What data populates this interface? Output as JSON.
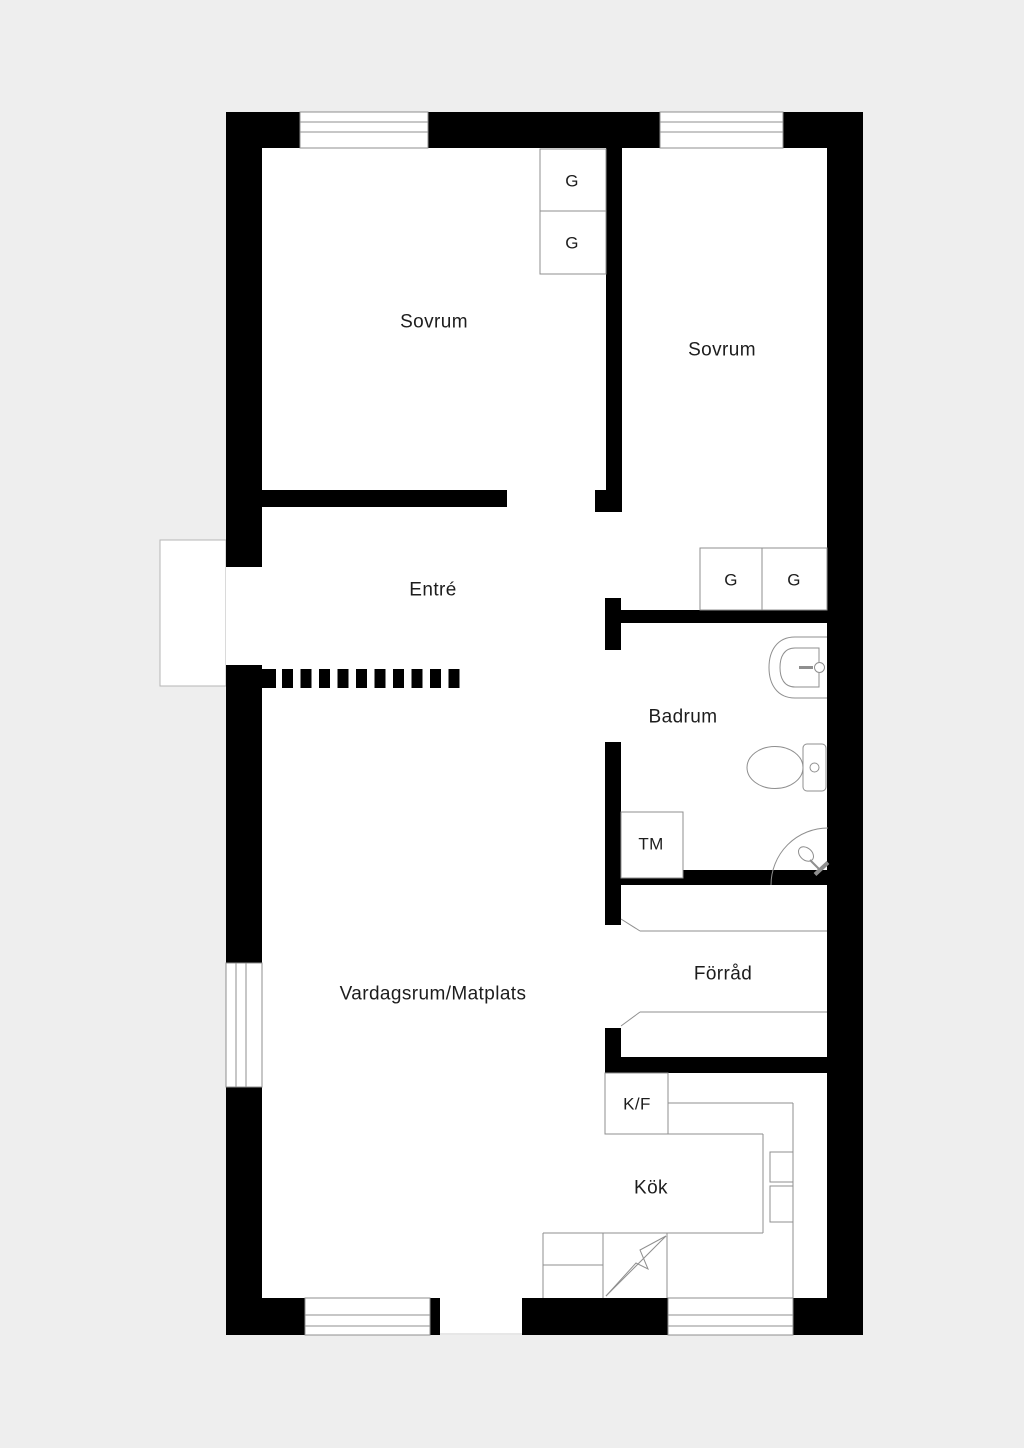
{
  "colors": {
    "background": "#eeeeee",
    "floor": "#ffffff",
    "wall": "#000000",
    "line": "#8f8f8f",
    "line_light": "#b5b5b5",
    "threshold": "#cfcfcf",
    "text": "#1d1d1d"
  },
  "labels": [
    {
      "name": "room-label-sovrum-1",
      "text": "Sovrum",
      "x": 434,
      "y": 322,
      "size": 19
    },
    {
      "name": "room-label-sovrum-2",
      "text": "Sovrum",
      "x": 722,
      "y": 350,
      "size": 19
    },
    {
      "name": "room-label-entre",
      "text": "Entré",
      "x": 433,
      "y": 590,
      "size": 19
    },
    {
      "name": "room-label-badrum",
      "text": "Badrum",
      "x": 683,
      "y": 717,
      "size": 19
    },
    {
      "name": "room-label-forrad",
      "text": "Förråd",
      "x": 723,
      "y": 974,
      "size": 19
    },
    {
      "name": "room-label-kok",
      "text": "Kök",
      "x": 651,
      "y": 1188,
      "size": 19
    },
    {
      "name": "room-label-vardagsrum",
      "text": "Vardagsrum/Matplats",
      "x": 433,
      "y": 994,
      "size": 19
    },
    {
      "name": "appliance-label-tm",
      "text": "TM",
      "x": 651,
      "y": 844,
      "size": 17
    },
    {
      "name": "appliance-label-kf",
      "text": "K/F",
      "x": 637,
      "y": 1104,
      "size": 17
    },
    {
      "name": "closet-label-g-1",
      "text": "G",
      "x": 572,
      "y": 181,
      "size": 17
    },
    {
      "name": "closet-label-g-2",
      "text": "G",
      "x": 572,
      "y": 243,
      "size": 17
    },
    {
      "name": "closet-label-g-3",
      "text": "G",
      "x": 731,
      "y": 580,
      "size": 17
    },
    {
      "name": "closet-label-g-4",
      "text": "G",
      "x": 794,
      "y": 580,
      "size": 17
    }
  ],
  "plan": {
    "porch": {
      "name": "entrance-porch",
      "x": 160,
      "y": 540,
      "w": 66,
      "h": 146
    },
    "floor": {
      "name": "interior-floor",
      "x": 262,
      "y": 148,
      "w": 565,
      "h": 1150
    },
    "walls": [
      {
        "name": "wall-top",
        "x": 226,
        "y": 112,
        "w": 637,
        "h": 36
      },
      {
        "name": "wall-bottom",
        "x": 226,
        "y": 1298,
        "w": 637,
        "h": 37
      },
      {
        "name": "wall-left",
        "x": 226,
        "y": 112,
        "w": 36,
        "h": 1223
      },
      {
        "name": "wall-right",
        "x": 827,
        "y": 112,
        "w": 36,
        "h": 1223
      },
      {
        "name": "wall-sovrum1-south",
        "x": 262,
        "y": 490,
        "w": 245,
        "h": 17
      },
      {
        "name": "wall-bedroom-divider",
        "x": 606,
        "y": 148,
        "w": 16,
        "h": 364
      },
      {
        "name": "wall-door-jamb",
        "x": 595,
        "y": 490,
        "w": 27,
        "h": 22
      },
      {
        "name": "wall-hall-segment",
        "x": 605,
        "y": 598,
        "w": 16,
        "h": 52
      },
      {
        "name": "wall-badrum-north",
        "x": 621,
        "y": 610,
        "w": 206,
        "h": 13
      },
      {
        "name": "wall-badrum-west",
        "x": 605,
        "y": 742,
        "w": 16,
        "h": 183
      },
      {
        "name": "wall-forrad-north",
        "x": 621,
        "y": 870,
        "w": 206,
        "h": 15
      },
      {
        "name": "wall-forrad-west",
        "x": 605,
        "y": 1028,
        "w": 16,
        "h": 29
      },
      {
        "name": "wall-kitchen-north",
        "x": 605,
        "y": 1057,
        "w": 222,
        "h": 16
      },
      {
        "name": "wall-divider-stub",
        "x": 262,
        "y": 669,
        "w": 14,
        "h": 19
      }
    ],
    "openings": [
      {
        "name": "entrance-opening",
        "x": 226,
        "y": 567,
        "w": 36,
        "h": 98
      },
      {
        "name": "patio-opening",
        "x": 440,
        "y": 1298,
        "w": 82,
        "h": 37
      }
    ],
    "windows": [
      {
        "name": "window-top-left",
        "x": 300,
        "y": 112,
        "w": 128,
        "h": 36,
        "dir": "h",
        "lines": [
          122,
          132
        ]
      },
      {
        "name": "window-top-right",
        "x": 660,
        "y": 112,
        "w": 123,
        "h": 36,
        "dir": "h",
        "lines": [
          122,
          132
        ]
      },
      {
        "name": "window-left",
        "x": 226,
        "y": 963,
        "w": 36,
        "h": 124,
        "dir": "v",
        "lines": [
          236,
          246
        ]
      },
      {
        "name": "window-bottom-left",
        "x": 305,
        "y": 1298,
        "w": 125,
        "h": 37,
        "dir": "h",
        "lines": [
          1315,
          1326
        ]
      },
      {
        "name": "window-bottom-right",
        "x": 668,
        "y": 1298,
        "w": 125,
        "h": 37,
        "dir": "h",
        "lines": [
          1315,
          1326
        ]
      }
    ],
    "furniture_boxes": [
      {
        "name": "wardrobe-g1",
        "x": 540,
        "y": 149,
        "w": 66,
        "h": 62
      },
      {
        "name": "wardrobe-g2",
        "x": 540,
        "y": 211,
        "w": 66,
        "h": 63
      },
      {
        "name": "wardrobe-g3",
        "x": 700,
        "y": 548,
        "w": 62,
        "h": 62
      },
      {
        "name": "wardrobe-g4",
        "x": 762,
        "y": 548,
        "w": 65,
        "h": 62
      },
      {
        "name": "washing-machine",
        "x": 621,
        "y": 812,
        "w": 62,
        "h": 66
      },
      {
        "name": "fridge-freezer",
        "x": 605,
        "y": 1073,
        "w": 63,
        "h": 61
      },
      {
        "name": "counter-sink-box-1",
        "x": 770,
        "y": 1152,
        "w": 23,
        "h": 30
      },
      {
        "name": "counter-sink-box-2",
        "x": 770,
        "y": 1186,
        "w": 23,
        "h": 36
      }
    ],
    "lines": [
      {
        "name": "kitchen-counter-edge-top",
        "x1": 668,
        "y1": 1103,
        "x2": 793,
        "y2": 1103
      },
      {
        "name": "kitchen-counter-edge-right",
        "x1": 793,
        "y1": 1103,
        "x2": 793,
        "y2": 1298
      },
      {
        "name": "kitchen-floor-line-top",
        "x1": 605,
        "y1": 1134,
        "x2": 763,
        "y2": 1134
      },
      {
        "name": "kitchen-floor-line-right",
        "x1": 763,
        "y1": 1134,
        "x2": 763,
        "y2": 1233
      },
      {
        "name": "kitchen-floor-line-bottom",
        "x1": 543,
        "y1": 1233,
        "x2": 763,
        "y2": 1233
      },
      {
        "name": "counter-left-edge",
        "x1": 543,
        "y1": 1233,
        "x2": 543,
        "y2": 1298
      },
      {
        "name": "stove-left-edge",
        "x1": 603,
        "y1": 1233,
        "x2": 603,
        "y2": 1298
      },
      {
        "name": "stove-right-edge",
        "x1": 667,
        "y1": 1233,
        "x2": 667,
        "y2": 1298
      },
      {
        "name": "counter-divider",
        "x1": 543,
        "y1": 1265,
        "x2": 603,
        "y2": 1265
      },
      {
        "name": "forrad-door-top",
        "x1": 640,
        "y1": 931,
        "x2": 827,
        "y2": 931
      },
      {
        "name": "forrad-door-top-hinge",
        "x1": 621,
        "y1": 919,
        "x2": 640,
        "y2": 931
      },
      {
        "name": "forrad-door-bottom",
        "x1": 640,
        "y1": 1012,
        "x2": 827,
        "y2": 1012
      },
      {
        "name": "forrad-door-bottom-hinge",
        "x1": 621,
        "y1": 1026,
        "x2": 640,
        "y2": 1012
      },
      {
        "name": "patio-opening-threshold",
        "x1": 440,
        "y1": 1334,
        "x2": 522,
        "y2": 1334,
        "light": true
      }
    ],
    "dashed_divider": {
      "name": "open-plan-divider-dash",
      "x": 282,
      "y": 669,
      "count": 10,
      "dash_w": 11,
      "dash_h": 19,
      "gap": 7.5
    },
    "fixtures": [
      {
        "name": "sink-outline",
        "tag": "path",
        "attrs": {
          "d": "M827 637 L795 637 C777 637 769 651 769 667.5 C769 684 777 698 795 698 L827 698",
          "fill": "none"
        }
      },
      {
        "name": "sink-basin",
        "tag": "path",
        "attrs": {
          "d": "M819 648 L795 648 C784 648 780 657 780 667.5 C780 678 784 687 795 687 L819 687 Z",
          "fill": "#ffffff"
        }
      },
      {
        "name": "sink-tap-line",
        "tag": "line",
        "attrs": {
          "x1": 799,
          "y1": 667.5,
          "x2": 813,
          "y2": 667.5,
          "stroke-width": 3
        }
      },
      {
        "name": "sink-tap-knob",
        "tag": "circle",
        "attrs": {
          "cx": 819.5,
          "cy": 667.5,
          "r": 5,
          "fill": "#ffffff"
        }
      },
      {
        "name": "toilet-tank",
        "tag": "rect",
        "attrs": {
          "x": 803,
          "y": 744,
          "width": 23,
          "height": 47,
          "rx": 4,
          "fill": "#ffffff"
        }
      },
      {
        "name": "toilet-flush-button",
        "tag": "circle",
        "attrs": {
          "cx": 814.5,
          "cy": 767.5,
          "r": 4.5,
          "fill": "#ffffff"
        }
      },
      {
        "name": "toilet-bowl",
        "tag": "ellipse",
        "attrs": {
          "cx": 775,
          "cy": 767.5,
          "rx": 28,
          "ry": 21,
          "fill": "#ffffff"
        }
      },
      {
        "name": "shower-arc",
        "tag": "path",
        "attrs": {
          "d": "M771 885 A57 57 0 0 1 828 828",
          "fill": "none"
        }
      },
      {
        "name": "shower-head",
        "tag": "ellipse",
        "attrs": {
          "cx": 806,
          "cy": 854,
          "rx": 8.5,
          "ry": 6,
          "transform": "rotate(42 806 854)",
          "fill": "#ffffff"
        }
      },
      {
        "name": "shower-hose",
        "tag": "line",
        "attrs": {
          "x1": 810,
          "y1": 860,
          "x2": 821,
          "y2": 871,
          "stroke-width": 2
        }
      },
      {
        "name": "shower-handle-bar",
        "tag": "line",
        "attrs": {
          "x1": 815,
          "y1": 874.5,
          "x2": 828,
          "y2": 862.5,
          "stroke-width": 4
        }
      },
      {
        "name": "stove-bolt-line",
        "tag": "path",
        "attrs": {
          "d": "M606 1296 L666 1236",
          "fill": "none"
        }
      },
      {
        "name": "stove-bolt-zigzag",
        "tag": "path",
        "attrs": {
          "d": "M606 1296 L636 1263 L648 1269 L640 1250 L666 1236",
          "fill": "none"
        }
      }
    ]
  }
}
